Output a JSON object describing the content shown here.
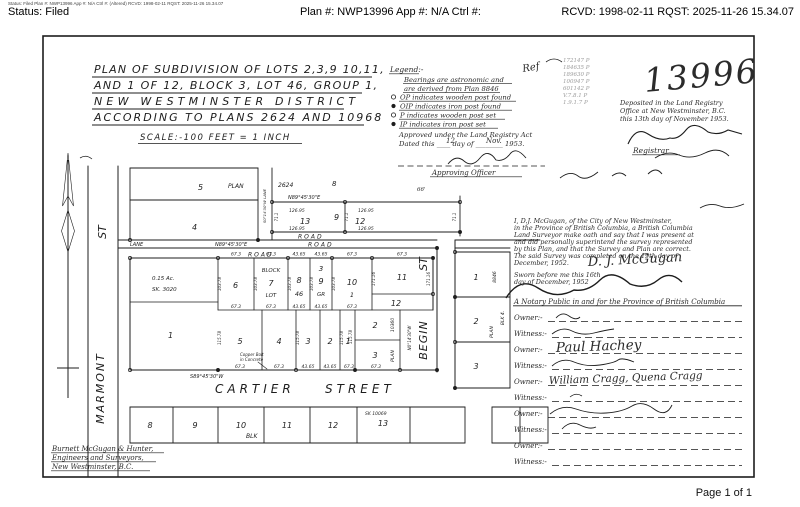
{
  "header": {
    "tiny": "Status: Filed      Plan #: NWP13996 App #: N/A Ctrl #:   (Altered) RCVD: 1998-02-11 RQST: 2025-11-26 15.34.07",
    "status": "Status: Filed",
    "plan": "Plan #: NWP13996 App #: N/A Ctrl #:",
    "rcvd": "RCVD: 1998-02-11 RQST: 2025-11-26 15.34.07"
  },
  "footer": {
    "page": "Page 1 of 1"
  },
  "doc": {
    "title": {
      "l1": "PLAN OF SUBDIVISION OF LOTS 2,3,9 10,11,",
      "l2": "AND 1 OF 12, BLOCK 3, LOT 46, GROUP 1,",
      "l3": "NEW WESTMINSTER DISTRICT",
      "l4": "ACCORDING TO PLANS 2624 AND 10968",
      "scale": "SCALE:-100 FEET = 1 INCH"
    },
    "legend": {
      "head": "Legend:-",
      "b1": "Bearings are astronomic and",
      "b2": "are derived from Plan 8846",
      "i1": "OP indicates wooden post found",
      "i2": "OIP indicates iron post found",
      "i3": "P indicates wooden post set",
      "i4": "IP indicates iron post set"
    },
    "ref": {
      "label": "Ref",
      "n1": "172147 P",
      "n2": "184635 P",
      "n3": "189630 P",
      "n4": "100947 P",
      "n5": "601142 P",
      "n6": "V.7.8.1 P",
      "n7": "1.9.1.7 P"
    },
    "plan_no": "13996",
    "deposit": {
      "l1": "Deposited in the Land Registry",
      "l2": "Office at New Westminster, B.C.",
      "l3": "this 13th day of November 1953.",
      "registrar": "Registrar"
    },
    "approval": {
      "l1": "Approved under the Land Registry Act",
      "l2": "Dated this ____ day of ________ 1953.",
      "day": "12",
      "month": "Nov.",
      "officer": "Approving Officer"
    },
    "affidavit": {
      "l1": "I, D.J. McGugan, of the City of New Westminster,",
      "l2": "in the Province of British Columbia, a British Columbia",
      "l3": "Land Surveyor make oath and say that I was present at",
      "l4": "and did personally superintend the survey represented",
      "l5": "by this Plan, and that the Survey and Plan are correct.",
      "l6": "The said Survey was completed on the 19th day of",
      "l7": "December, 1952.",
      "sig": "D. J. McGugan",
      "sworn1": "Sworn before me this 16th",
      "sworn2": "day of December, 1952",
      "notary": "A Notary Public in and for the Province of British Columbia"
    },
    "owners": {
      "owner": "Owner:-",
      "witness": "Witness:-",
      "name1": "Paul Hachey",
      "name2": "William Cragg, Quena Cragg"
    },
    "firm": {
      "l1": "Burnett McGugan & Hunter,",
      "l2": "Engineers and Surveyors,",
      "l3": "New Westminster,  B.C."
    },
    "map": {
      "marmont": "MARMONT",
      "st": "ST",
      "begin": "BEGIN",
      "cartier": "CARTIER",
      "street": "STREET",
      "lane": "LANE",
      "road": "ROAD",
      "blk": "BLK",
      "blk4": "BLK 4.",
      "plan": "PLAN",
      "p2624": "2624",
      "p8": "8",
      "p8846": "8846",
      "p10360": "10360",
      "sk10069": "SK 10069",
      "sk3020": "SK. 3020",
      "acre": "0.15 Ac.",
      "block": "BLOCK",
      "lot": "LOT",
      "gr": "GR",
      "g46": "46",
      "bearing_e": "N89°45'30\"E",
      "bearing_w": "S89°45'30\"W",
      "bearing_n": "N0°14'30\"W",
      "lane_vert": "S0°14'30\"W LANE",
      "m66": "66'",
      "m711": "71.1",
      "m12695": "126.95",
      "m673": "67.3",
      "m4365": "43.65",
      "m10378": "103.78",
      "m11578": "115.78",
      "m17116": "171.16",
      "copper1": "Copper Bolt",
      "copper2": "in Concrete",
      "n1": "1",
      "n2": "2",
      "n3": "3",
      "n4": "4",
      "n5": "5",
      "n6": "6",
      "n7": "7",
      "n8": "8",
      "n9": "9",
      "n10": "10",
      "n11": "11",
      "n12": "12",
      "n13": "13"
    }
  }
}
